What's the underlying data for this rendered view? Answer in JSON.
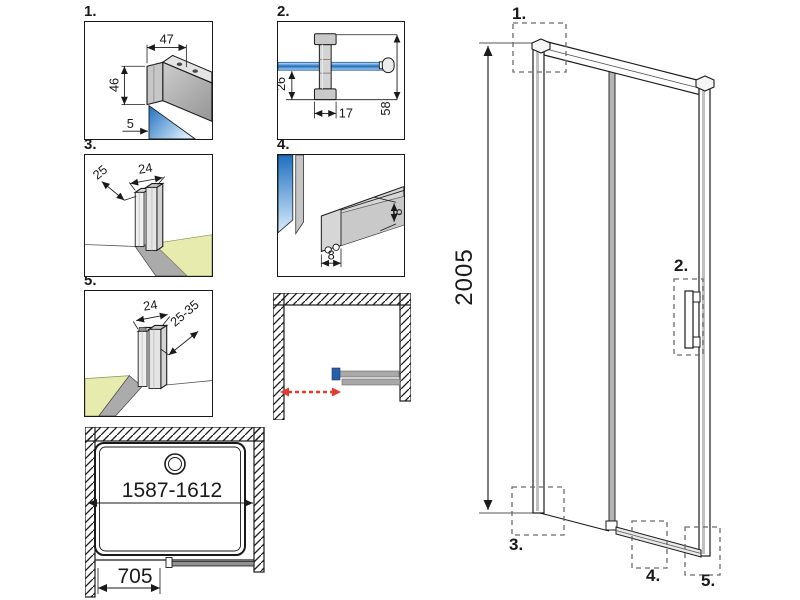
{
  "drawing": {
    "details": {
      "d1": {
        "label": "1.",
        "dim_top": "47",
        "dim_side": "46",
        "dim_glass": "5"
      },
      "d2": {
        "label": "2.",
        "dim_offset": "26",
        "dim_width": "17",
        "dim_height": "58"
      },
      "d3": {
        "label": "3.",
        "dim_depth": "25",
        "dim_width": "24"
      },
      "d4": {
        "label": "4.",
        "dim_height": "8",
        "dim_width": "8"
      },
      "d5": {
        "label": "5.",
        "dim_width": "24",
        "dim_range": "25-35"
      }
    },
    "plan": {
      "dim_width_range": "1587-1612",
      "dim_door_width": "705"
    },
    "elevation": {
      "dim_height": "2005",
      "callout_1": "1.",
      "callout_2": "2.",
      "callout_3": "3.",
      "callout_4": "4.",
      "callout_5": "5."
    },
    "colors": {
      "glass_deep": "#1e6fc0",
      "glass_light": "#d9ecfb",
      "floor_green": "#e7ebae",
      "arrow_red": "#e23b30",
      "handle_blue": "#2a5ca8"
    }
  }
}
